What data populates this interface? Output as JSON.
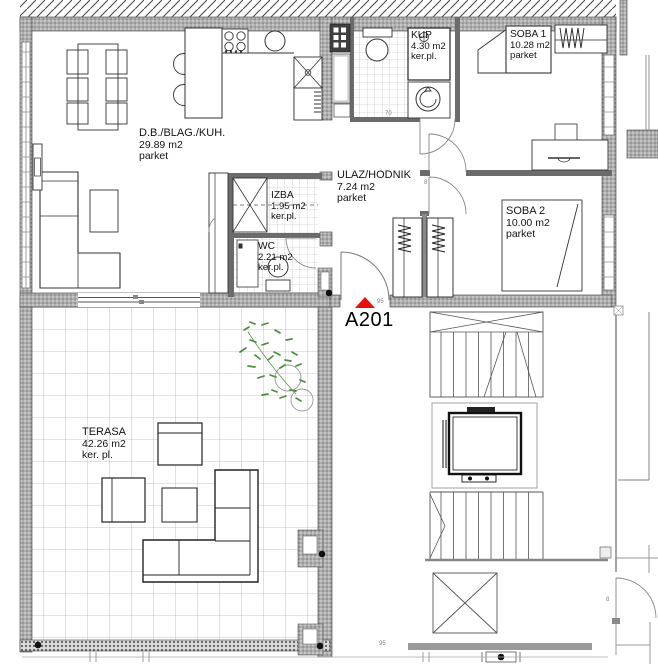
{
  "plan": {
    "unit": {
      "code": "A201"
    },
    "rooms": [
      {
        "name": "D.B./BLAG./KUH.",
        "area": "29.89 m2",
        "floor": "parket"
      },
      {
        "name": "KUP",
        "area": "4.30 m2",
        "floor": "ker.pl."
      },
      {
        "name": "SOBA 1",
        "area": "10.28 m2",
        "floor": "parket"
      },
      {
        "name": "ULAZ/HODNIK",
        "area": "7.24 m2",
        "floor": "parket"
      },
      {
        "name": "IZBA",
        "area": "1.95 m2",
        "floor": "ker.pl."
      },
      {
        "name": "WC",
        "area": "2.21 m2",
        "floor": "ker.pl."
      },
      {
        "name": "SOBA 2",
        "area": "10.00 m2",
        "floor": "parket"
      },
      {
        "name": "TERASA",
        "area": "42.26 m2",
        "floor": "ker. pl."
      }
    ],
    "dimensions": {
      "kup_door": "70",
      "entry_door": "95",
      "soba_door": "8",
      "stair_door": "8",
      "stair_width": "95"
    },
    "colors": {
      "marker_red": "#e8100c",
      "plant_green": "#4e8c3e",
      "wall_gray": "#ababab"
    }
  }
}
